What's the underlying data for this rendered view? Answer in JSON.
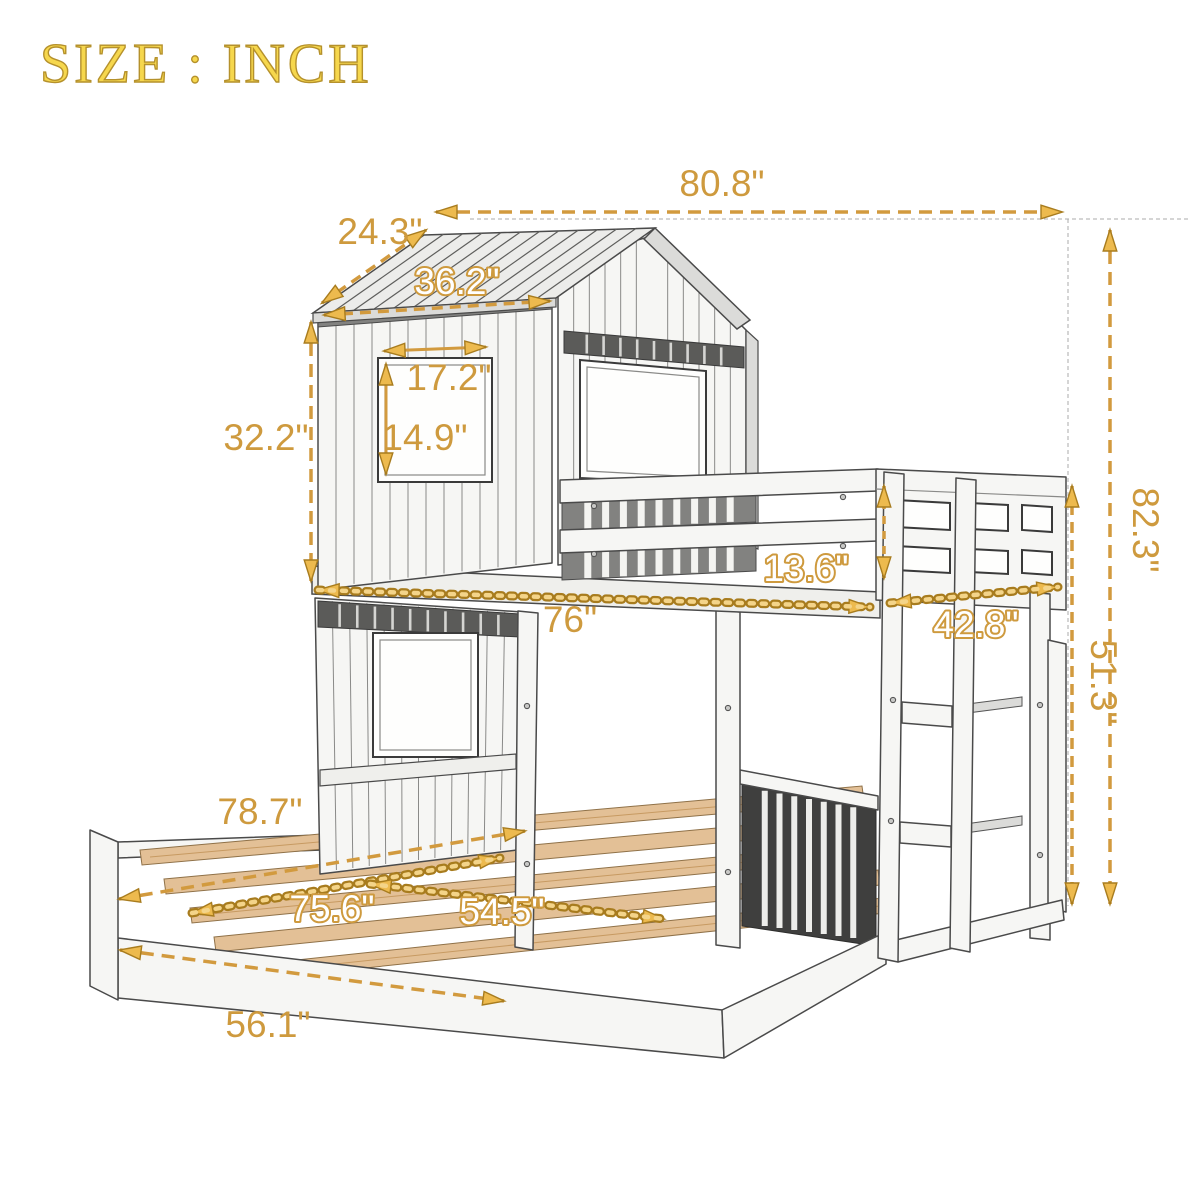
{
  "title": "SIZE : INCH",
  "colors": {
    "dimension_accent": "#D29A3E",
    "dimension_chain_dark": "#A87C1E",
    "dimension_chain_light": "#F4D489",
    "title_fill": "#F6D74D",
    "title_stroke": "#B5912C",
    "sketch_line": "#4A4A4A",
    "wood_slat": "#E3C096"
  },
  "dimensions": {
    "total_length": {
      "label": "80.8\""
    },
    "roof_depth": {
      "label": "24.3\""
    },
    "roof_side": {
      "label": "36.2\""
    },
    "window_width": {
      "label": "17.2\""
    },
    "window_height": {
      "label": "14.9\""
    },
    "house_height": {
      "label": "32.2\""
    },
    "guardrail_height": {
      "label": "13.6\""
    },
    "upper_bed_length": {
      "label": "76\""
    },
    "ladder_width": {
      "label": "42.8\""
    },
    "total_height": {
      "label": "82.3\""
    },
    "upper_height": {
      "label": "51.3\""
    },
    "lower_bed_length": {
      "label": "78.7\""
    },
    "slat_length": {
      "label": "75.6\""
    },
    "lower_bed_width": {
      "label": "54.5\""
    },
    "frame_width": {
      "label": "56.1\""
    }
  }
}
